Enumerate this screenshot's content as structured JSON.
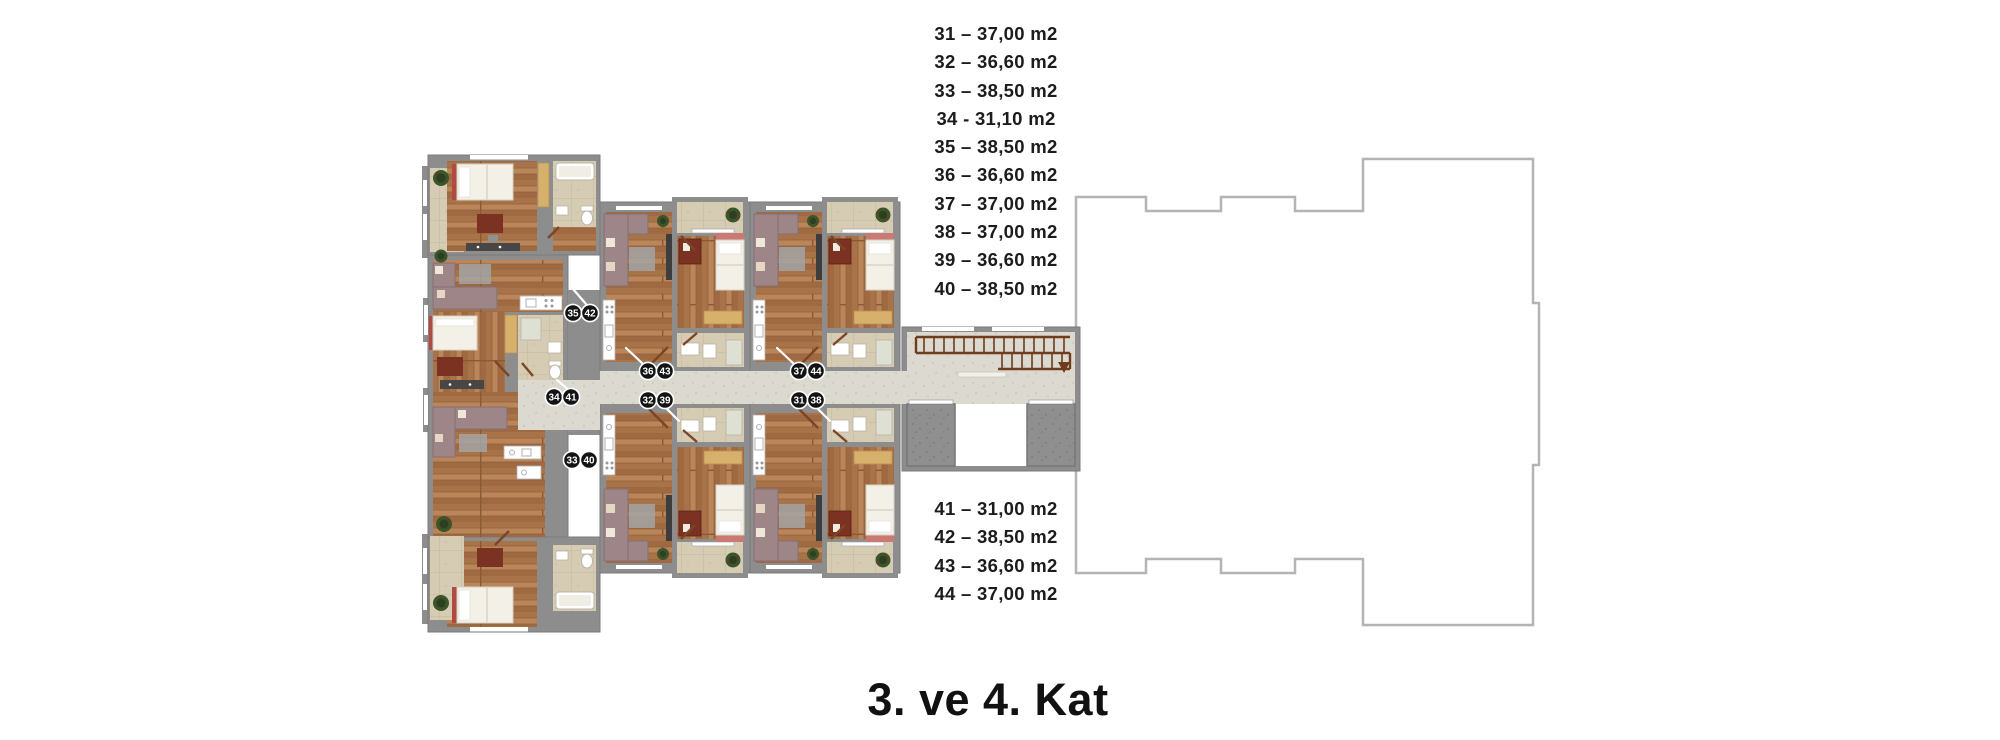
{
  "title": "3. ve 4. Kat",
  "unit_areas": {
    "top": [
      "31 – 37,00 m2",
      "32 – 36,60 m2",
      "33 – 38,50 m2",
      "34 - 31,10 m2",
      "35 – 38,50 m2",
      "36 – 36,60 m2",
      "37 – 37,00 m2",
      "38 – 37,00 m2",
      "39 – 36,60 m2",
      "40 – 38,50 m2"
    ],
    "bottom": [
      "41 – 31,00 m2",
      "42 – 38,50 m2",
      "43 – 36,60 m2",
      "44 – 37,00 m2"
    ]
  },
  "unit_labels": [
    {
      "a": "35",
      "b": "42"
    },
    {
      "a": "36",
      "b": "43"
    },
    {
      "a": "37",
      "b": "44"
    },
    {
      "a": "34",
      "b": "41"
    },
    {
      "a": "32",
      "b": "39"
    },
    {
      "a": "31",
      "b": "38"
    },
    {
      "a": "33",
      "b": "40"
    }
  ],
  "colors": {
    "text": "#1c1c1c",
    "label_circle": "#131313",
    "label_text": "#ffffff",
    "wall": "#8d8d8d",
    "wood_floor": "#b07c50",
    "balcony_tile": "#d5ccb3",
    "corridor_stone": "#dcd9d1",
    "shaft_gray": "#8f8f8f",
    "sofa_mauve": "#9d8588",
    "bed_white": "#f3f0e8",
    "accent_red": "#b04a42",
    "wardrobe_tan": "#d7b06c",
    "desk_brown": "#7b3223",
    "stair_rail": "#6f3c1c",
    "plant_green": "#3c5429",
    "building_outline": "#b4b4b4"
  }
}
